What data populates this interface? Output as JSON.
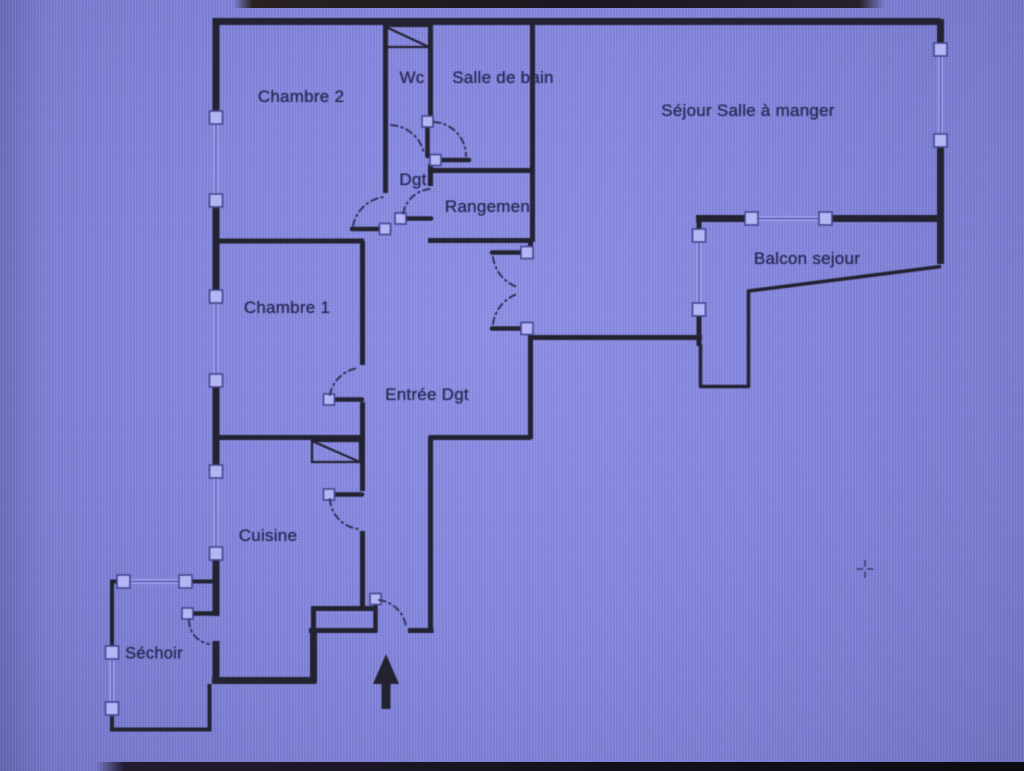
{
  "plan": {
    "title": "apartment-floor-plan",
    "rooms": [
      {
        "id": "chambre2",
        "label": "Chambre 2"
      },
      {
        "id": "wc",
        "label": "Wc"
      },
      {
        "id": "salle-de-bain",
        "label": "Salle de bain"
      },
      {
        "id": "sejour",
        "label": "Séjour Salle à manger"
      },
      {
        "id": "dgt",
        "label": "Dgt"
      },
      {
        "id": "rangement",
        "label": "Rangement"
      },
      {
        "id": "balcon",
        "label": "Balcon sejour"
      },
      {
        "id": "chambre1",
        "label": "Chambre 1"
      },
      {
        "id": "entree",
        "label": "Entrée Dgt"
      },
      {
        "id": "cuisine",
        "label": "Cuisine"
      },
      {
        "id": "sechoir",
        "label": "Séchoir"
      }
    ],
    "symbols": {
      "entrance_arrow": "arrow-up",
      "cursor": "crosshair",
      "window": "square-end-boxes-with-thin-double-line",
      "door": "leaf-bar-with-dash-dot-swing-arc"
    },
    "colors": {
      "background": "#8285da",
      "wall": "#232230",
      "window_box_fill": "#b4b5f4",
      "window_box_stroke": "#44468f",
      "window_line": "#a0a2ec",
      "text": "#272750",
      "photo_edge": "#17121a"
    }
  }
}
